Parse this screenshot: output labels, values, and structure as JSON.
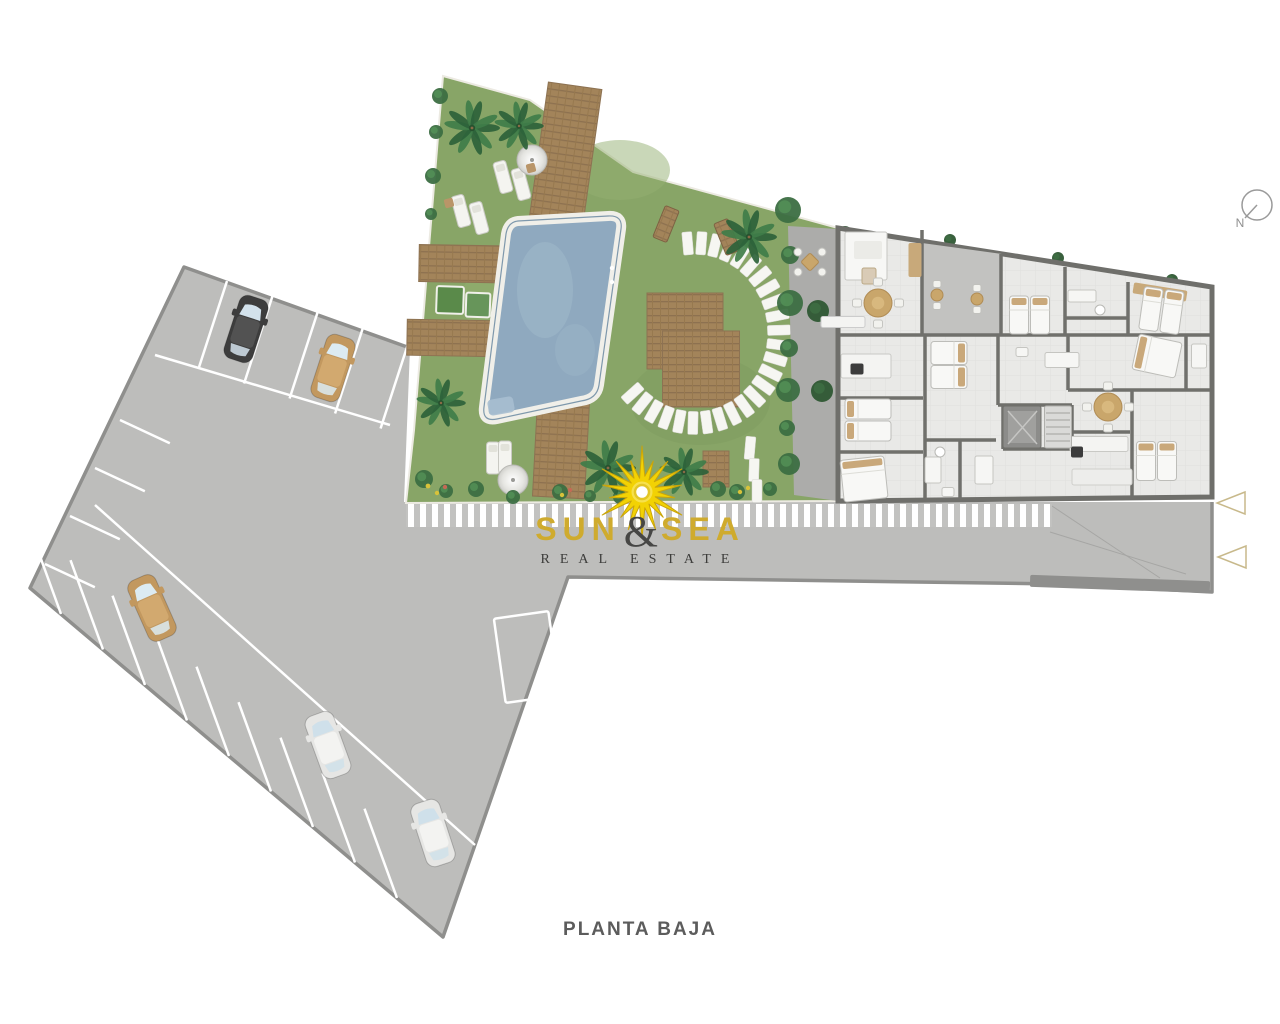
{
  "title": {
    "plan_label": "PLANTA BAJA"
  },
  "logo": {
    "word_left": "SUN",
    "ampersand": "&",
    "word_right": "SEA",
    "tagline": "REAL ESTATE"
  },
  "compass": {
    "label": "N"
  },
  "palette": {
    "gold": "#cfab2e",
    "sun_yellow": "#f2d204",
    "grass": "#88a567",
    "pool_water": "#8fa9bf",
    "pavement": "#bdbdbb",
    "pavement_edge": "#8f8f8d",
    "wall": "#70706c",
    "floor": "#e9e9e7",
    "wood": "#a3845a",
    "hedge_green": "#3c6e42",
    "marker_tan": "#c8b98b"
  },
  "scene": {
    "car_colors": {
      "dark": {
        "body": "#3d3d3d",
        "roof": "#525252",
        "glass": "#d3e2ec"
      },
      "tan": {
        "body": "#c2985f",
        "roof": "#d2a96f",
        "glass": "#dcebf2"
      },
      "white": {
        "body": "#e6e6e4",
        "roof": "#f3f3f1",
        "glass": "#cfe0ea"
      }
    },
    "cars": [
      [
        246,
        329,
        18,
        "dark"
      ],
      [
        333,
        368,
        18,
        "tan"
      ],
      [
        152,
        608,
        -24,
        "tan"
      ],
      [
        328,
        745,
        -20,
        "white"
      ],
      [
        433,
        833,
        -18,
        "white"
      ]
    ],
    "bay_rows": [
      {
        "x": 227,
        "y": 281,
        "dx": 45.5,
        "dy": 15,
        "n": 5,
        "len": 92,
        "ang": -18
      },
      {
        "x": 61,
        "y": 614,
        "dx": 42,
        "dy": 35.5,
        "n": 9,
        "len": 95,
        "ang": 200
      },
      {
        "x": 120,
        "y": 420,
        "dx": -25,
        "dy": 48,
        "n": 4,
        "len": 55,
        "ang": 65
      }
    ],
    "palms": [
      [
        472,
        128,
        26
      ],
      [
        519,
        126,
        23
      ],
      [
        441,
        403,
        23
      ],
      [
        749,
        237,
        26
      ],
      [
        608,
        468,
        26
      ],
      [
        684,
        472,
        23
      ]
    ],
    "bushes": [
      [
        788,
        210,
        13,
        0
      ],
      [
        790,
        255,
        9,
        0
      ],
      [
        790,
        303,
        13,
        0
      ],
      [
        789,
        348,
        9,
        0
      ],
      [
        788,
        390,
        12,
        0
      ],
      [
        787,
        428,
        8,
        0
      ],
      [
        789,
        464,
        11,
        0
      ],
      [
        440,
        96,
        8,
        0
      ],
      [
        436,
        132,
        7,
        0
      ],
      [
        433,
        176,
        8,
        0
      ],
      [
        431,
        214,
        6,
        0
      ],
      [
        424,
        479,
        9,
        0
      ],
      [
        446,
        491,
        7,
        0
      ],
      [
        476,
        489,
        8,
        0
      ],
      [
        513,
        497,
        7,
        0
      ],
      [
        560,
        492,
        8,
        0
      ],
      [
        590,
        496,
        6,
        0
      ],
      [
        620,
        497,
        7,
        0
      ],
      [
        650,
        494,
        8,
        0
      ],
      [
        718,
        489,
        8,
        0
      ],
      [
        737,
        492,
        8,
        0
      ],
      [
        770,
        489,
        7,
        0
      ],
      [
        818,
        311,
        11,
        1
      ],
      [
        822,
        391,
        11,
        1
      ],
      [
        845,
        233,
        7,
        1
      ],
      [
        950,
        240,
        6,
        1
      ],
      [
        1058,
        258,
        6,
        1
      ],
      [
        1172,
        280,
        6,
        1
      ]
    ],
    "stones": {
      "arc": {
        "cx": 695,
        "cy": 333,
        "rx": 84,
        "ry": 90,
        "a0": -95,
        "a1": 138,
        "n": 26
      },
      "extra": [
        [
          750,
          448,
          5
        ],
        [
          754,
          470,
          2
        ],
        [
          757,
          491,
          0
        ]
      ]
    },
    "decks": [
      [
        564,
        165,
        54,
        160,
        8
      ],
      [
        477,
        264,
        116,
        37,
        1
      ],
      [
        453,
        338,
        92,
        36,
        1
      ],
      [
        685,
        331,
        76,
        76,
        0
      ],
      [
        701,
        369,
        77,
        76,
        0
      ],
      [
        561,
        449,
        52,
        97,
        3
      ],
      [
        716,
        469,
        26,
        36,
        0
      ],
      [
        1033,
        277,
        58,
        26,
        9
      ]
    ],
    "loungers": [
      [
        503,
        177,
        -15
      ],
      [
        521,
        184,
        -15
      ],
      [
        461,
        211,
        -15
      ],
      [
        479,
        218,
        -15
      ],
      [
        493,
        458,
        0
      ],
      [
        505,
        457,
        0
      ]
    ],
    "parasols": [
      [
        532,
        160,
        15
      ],
      [
        513,
        480,
        15
      ]
    ],
    "benches": [
      [
        666,
        224,
        15,
        34,
        22
      ],
      [
        727,
        237,
        15,
        34,
        -22
      ]
    ],
    "walls": [
      [
        922,
        230,
        922,
        334
      ],
      [
        1001,
        254,
        1001,
        334
      ],
      [
        840,
        335,
        1210,
        335
      ],
      [
        925,
        335,
        925,
        499
      ],
      [
        998,
        335,
        998,
        405
      ],
      [
        840,
        398,
        923,
        398
      ],
      [
        840,
        452,
        923,
        452
      ],
      [
        1065,
        267,
        1065,
        335
      ],
      [
        1128,
        282,
        1128,
        335
      ],
      [
        1065,
        318,
        1128,
        318
      ],
      [
        1068,
        335,
        1068,
        390
      ],
      [
        1068,
        390,
        1210,
        390
      ],
      [
        1132,
        390,
        1132,
        499
      ],
      [
        1070,
        432,
        1130,
        432
      ],
      [
        1186,
        335,
        1186,
        390
      ],
      [
        925,
        440,
        996,
        440
      ],
      [
        960,
        440,
        960,
        499
      ],
      [
        998,
        405,
        1072,
        405
      ],
      [
        1003,
        405,
        1003,
        449
      ],
      [
        1072,
        405,
        1072,
        449
      ],
      [
        1003,
        449,
        1072,
        449
      ]
    ],
    "beds": [
      [
        868,
        409,
        46,
        20,
        0,
        "left"
      ],
      [
        868,
        431,
        46,
        20,
        0,
        "left"
      ],
      [
        864,
        479,
        44,
        42,
        -6,
        "top"
      ],
      [
        949,
        353,
        36,
        23,
        0,
        "right"
      ],
      [
        949,
        377,
        36,
        23,
        0,
        "right"
      ],
      [
        1019,
        315,
        19,
        38,
        0,
        "top"
      ],
      [
        1040,
        315,
        19,
        38,
        0,
        "top"
      ],
      [
        1151,
        309,
        19,
        43,
        8,
        "top"
      ],
      [
        1172,
        312,
        19,
        43,
        8,
        "top"
      ],
      [
        1157,
        356,
        44,
        36,
        12,
        "left"
      ],
      [
        1146,
        461,
        19,
        39,
        0,
        "top"
      ],
      [
        1167,
        461,
        19,
        39,
        0,
        "top"
      ]
    ],
    "tables": [
      [
        878,
        303,
        14
      ],
      [
        1108,
        407,
        14
      ]
    ],
    "bistros": [
      [
        937,
        295
      ],
      [
        977,
        299
      ]
    ],
    "under": {
      "rects": [
        [
          527,
          657,
          55,
          85,
          -8,
          "none",
          "#ffffff",
          2.5
        ],
        [
          1120,
          584,
          180,
          12,
          2,
          "#8f8f8d",
          "none",
          0
        ]
      ],
      "lines": [
        [
          155,
          355,
          390,
          425,
          "#ffffff",
          2.5
        ],
        [
          95,
          505,
          475,
          845,
          "#ffffff",
          2.5
        ],
        [
          1050,
          532,
          1186,
          574,
          "#a6a6a4",
          1
        ],
        [
          1052,
          506,
          1160,
          578,
          "#a6a6a4",
          1
        ]
      ]
    },
    "over": {
      "rects": [
        [
          450,
          300,
          27,
          27,
          2,
          "#5a8a4a",
          "#f0f0ea",
          2
        ],
        [
          478,
          305,
          24,
          24,
          2,
          "#67955a",
          "#f0f0ea",
          2
        ],
        [
          531,
          168,
          9,
          9,
          -15,
          "#b99568",
          "none",
          0
        ],
        [
          449,
          203,
          9,
          9,
          -15,
          "#b99568",
          "none",
          0
        ],
        [
          866,
          256,
          42,
          48,
          0,
          "#f7f7f5",
          "#c6c6c2",
          1
        ],
        [
          868,
          250,
          28,
          18,
          0,
          "#ebebe7",
          "none",
          0
        ],
        [
          869,
          276,
          14,
          16,
          0,
          "#d9cbb6",
          "#bba886",
          1
        ],
        [
          866,
          366,
          50,
          24,
          0,
          "#f4f4f2",
          "#c9c9c5",
          1
        ],
        [
          857,
          369,
          13,
          11,
          0,
          "#3c3c3c",
          "none",
          0
        ],
        [
          843,
          322,
          44,
          11,
          0,
          "#f4f4f2",
          "#cccccc",
          1
        ],
        [
          915,
          260,
          13,
          34,
          0,
          "#c8a97a",
          "none",
          0
        ],
        [
          1160,
          292,
          54,
          11,
          9,
          "#c8a97a",
          "none",
          0
        ],
        [
          933,
          470,
          16,
          26,
          0,
          "#f6f6f4",
          "#c5c5c1",
          1
        ],
        [
          948,
          492,
          12,
          9,
          0,
          "#f6f6f4",
          "#c5c5c1",
          1
        ],
        [
          984,
          470,
          18,
          28,
          0,
          "#f6f6f4",
          "#c5c5c1",
          1
        ],
        [
          1082,
          296,
          28,
          12,
          0,
          "#f6f6f4",
          "#c5c5c1",
          1
        ],
        [
          1062,
          360,
          34,
          15,
          0,
          "#f6f6f4",
          "#c5c5c1",
          1
        ],
        [
          1022,
          352,
          12,
          9,
          0,
          "#f6f6f4",
          "#c5c5c1",
          1
        ],
        [
          1199,
          356,
          15,
          24,
          0,
          "#f6f6f4",
          "#c5c5c1",
          1
        ],
        [
          1099,
          444,
          58,
          15,
          0,
          "#f4f4f2",
          "#c9c9c5",
          1
        ],
        [
          1077,
          452,
          12,
          11,
          0,
          "#3c3c3c",
          "none",
          0
        ],
        [
          1102,
          477,
          60,
          16,
          0,
          "#ededeb",
          "#cfcfcb",
          1
        ],
        [
          1022,
          427,
          38,
          42,
          0,
          "#8c8c8a",
          "#6f6f6b",
          1
        ],
        [
          1022,
          427,
          28,
          32,
          0,
          "#a0a09e",
          "none",
          0
        ],
        [
          1058,
          427,
          27,
          42,
          0,
          "#dadad8",
          "#b0b0ac",
          1
        ],
        [
          810,
          262,
          13,
          13,
          45,
          "#c9a66b",
          "#b08c55",
          1
        ]
      ],
      "circles": [
        [
          798,
          252,
          4,
          "#f2f2ee",
          "#c0c0bc"
        ],
        [
          822,
          252,
          4,
          "#f2f2ee",
          "#c0c0bc"
        ],
        [
          798,
          272,
          4,
          "#f2f2ee",
          "#c0c0bc"
        ],
        [
          822,
          272,
          4,
          "#f2f2ee",
          "#c0c0bc"
        ],
        [
          940,
          452,
          5,
          "#ffffff",
          "#b9b9b5"
        ],
        [
          1100,
          310,
          5,
          "#ffffff",
          "#b9b9b5"
        ],
        [
          612,
          268,
          2.2,
          "#ffffff",
          "none"
        ],
        [
          612,
          282,
          2.2,
          "#ffffff",
          "none"
        ],
        [
          428,
          486,
          2.4,
          "#d8c23a",
          "none"
        ],
        [
          437,
          493,
          2.2,
          "#d8c23a",
          "none"
        ],
        [
          445,
          487,
          2.2,
          "#c46a55",
          "none"
        ],
        [
          562,
          495,
          2.2,
          "#d8c23a",
          "none"
        ],
        [
          570,
          490,
          2.2,
          "#c46a55",
          "none"
        ],
        [
          740,
          492,
          2.2,
          "#d8c23a",
          "none"
        ],
        [
          748,
          488,
          2.2,
          "#d8c23a",
          "none"
        ]
      ],
      "lines": [
        [
          1046,
          413,
          1070,
          413,
          "#b5b5b1",
          1.5
        ],
        [
          1046,
          420,
          1070,
          420,
          "#b5b5b1",
          1.5
        ],
        [
          1046,
          427,
          1070,
          427,
          "#b5b5b1",
          1.5
        ],
        [
          1046,
          434,
          1070,
          434,
          "#b5b5b1",
          1.5
        ],
        [
          1046,
          441,
          1070,
          441,
          "#b5b5b1",
          1.5
        ],
        [
          1008,
          411,
          1037,
          444,
          "#c5c5c3",
          1.5
        ],
        [
          1037,
          411,
          1008,
          444,
          "#c5c5c3",
          1.5
        ]
      ]
    }
  }
}
